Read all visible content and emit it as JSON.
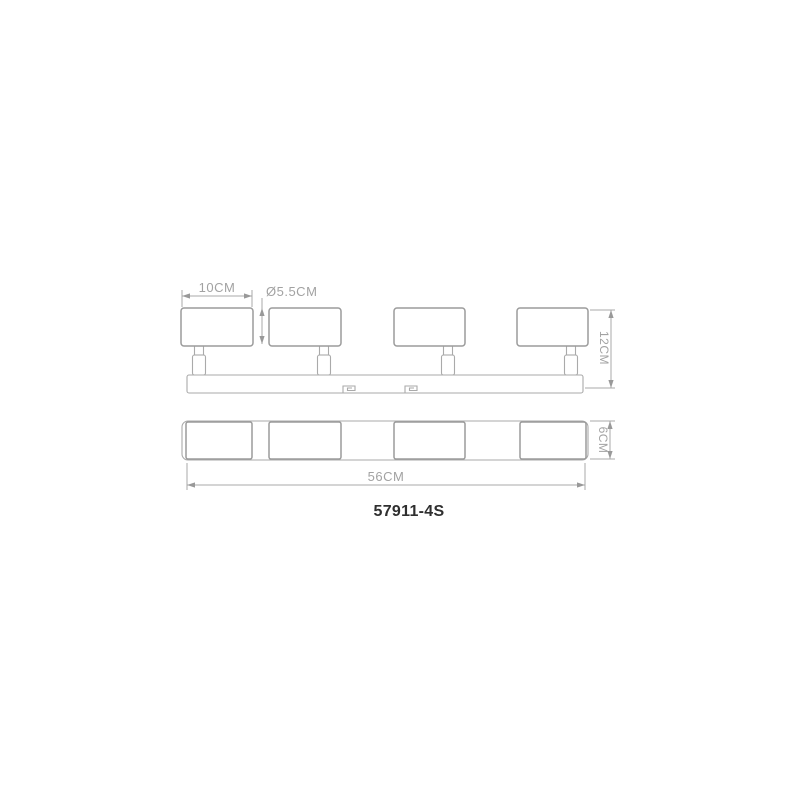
{
  "drawing": {
    "model_label": "57911-4S",
    "type_note": "4-head spotlight bar, side elevation and plan view",
    "head_count": 4
  },
  "dimensions": {
    "head_width": "10CM",
    "head_diameter": "Ø5.5CM",
    "total_height": "12CM",
    "bar_depth": "6CM",
    "total_width": "56CM"
  },
  "colors": {
    "background": "#ffffff",
    "outline": "#9b9b9b",
    "line": "#aaaaaa",
    "arrow": "#999999",
    "dim_text": "#a2a2a2",
    "model_text": "#2f2f2f"
  }
}
